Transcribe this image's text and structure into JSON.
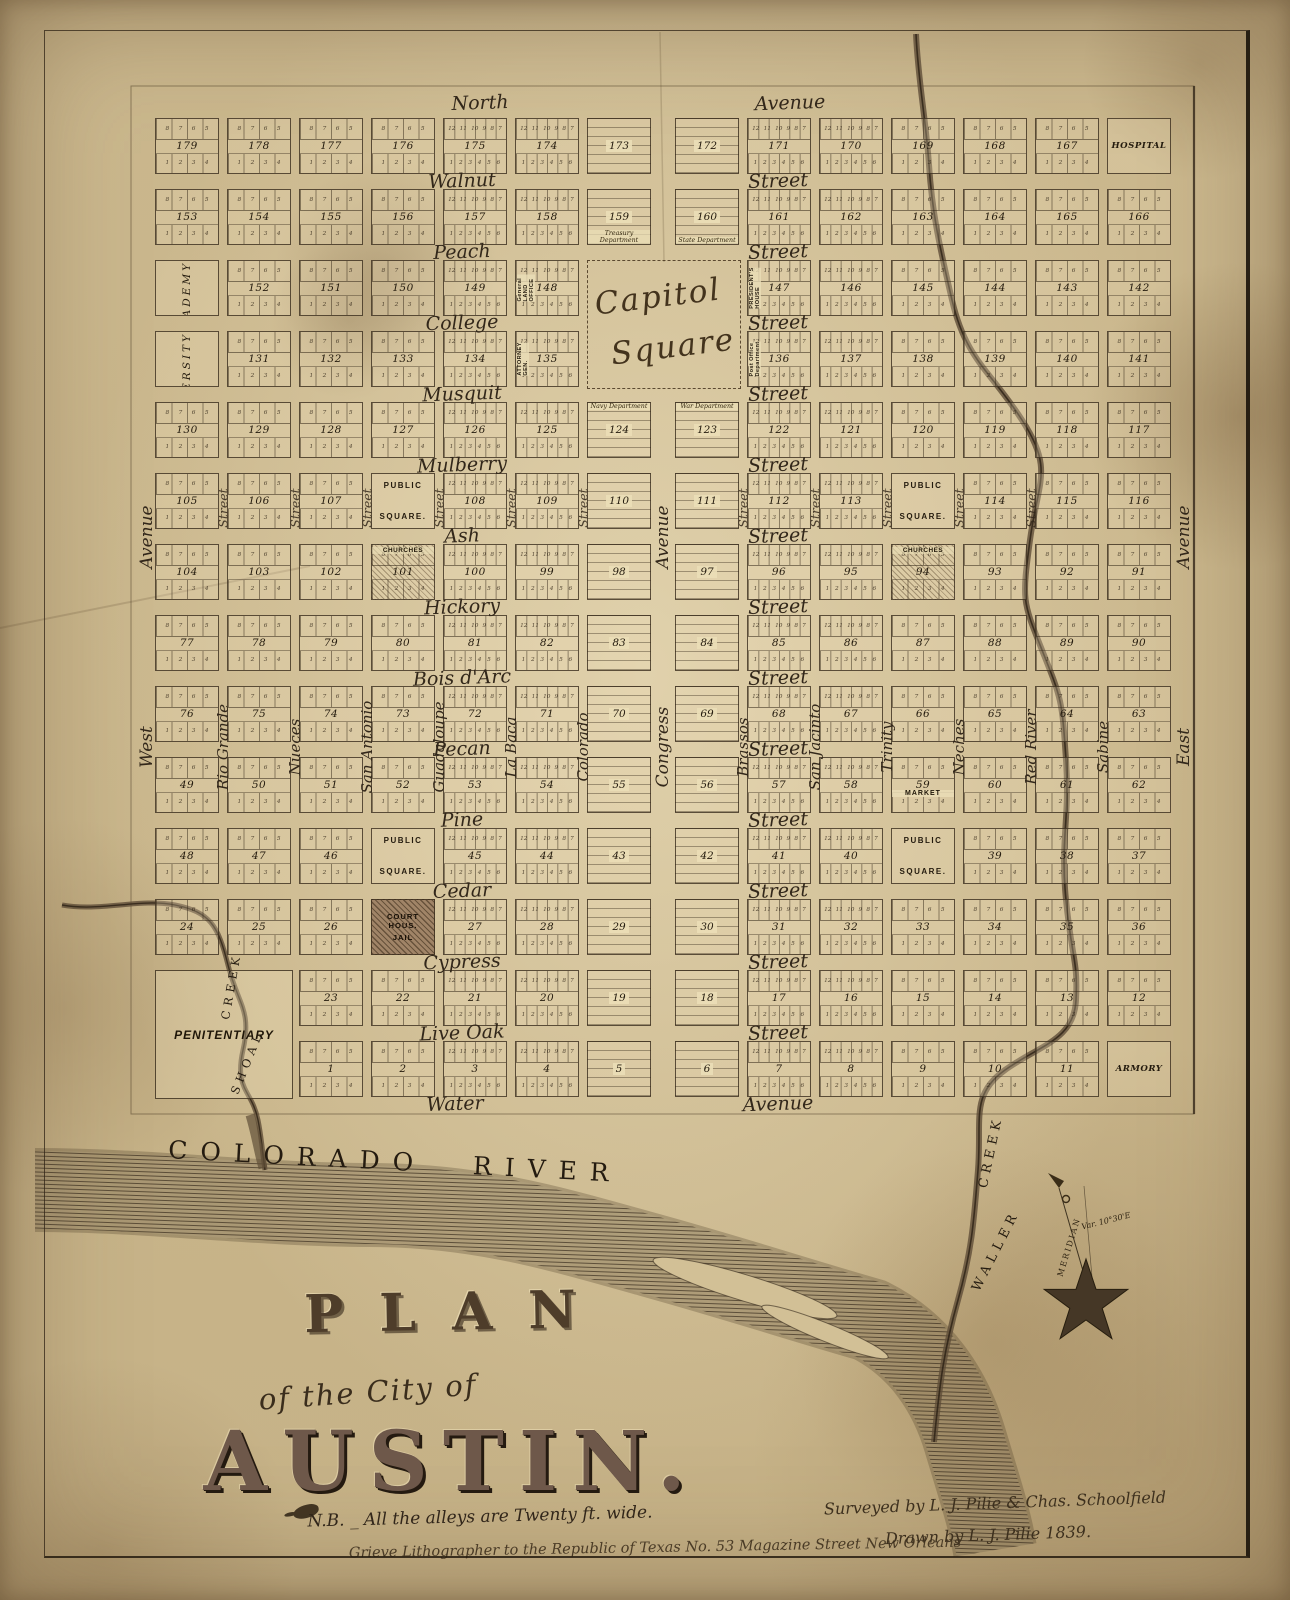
{
  "title": {
    "plan": "PLAN",
    "of_line": "of the City of",
    "city": "AUSTIN.",
    "nb_note": "N.B. _ All the alleys are Twenty ft. wide.",
    "lithographer": "Grieve Lithographer to the Republic of Texas No. 53 Magazine Street New Orleans",
    "surveyed": "Surveyed by L. J. Pilie & Chas. Schoolfield",
    "drawn": "Drawn by L. J. Pilie 1839."
  },
  "compass": {
    "meridian": "MERIDIAN",
    "variation": "Var. 10°30'E"
  },
  "waterways": {
    "river": "COLORADO RIVER",
    "creek_right_word1": "WALLER",
    "creek_right_word2": "CREEK",
    "creek_left_word1": "SHOAL",
    "creek_left_word2": "CREEK"
  },
  "streets": {
    "horizontal": [
      {
        "name": "North",
        "type": "Avenue"
      },
      {
        "name": "Walnut",
        "type": "Street"
      },
      {
        "name": "Peach",
        "type": "Street"
      },
      {
        "name": "College",
        "type": "Street"
      },
      {
        "name": "Musquit",
        "type": "Street"
      },
      {
        "name": "Mulberry",
        "type": "Street"
      },
      {
        "name": "Ash",
        "type": "Street"
      },
      {
        "name": "Hickory",
        "type": "Street"
      },
      {
        "name": "Bois d'Arc",
        "type": "Street"
      },
      {
        "name": "Pecan",
        "type": "Street"
      },
      {
        "name": "Pine",
        "type": "Street"
      },
      {
        "name": "Cedar",
        "type": "Street"
      },
      {
        "name": "Cypress",
        "type": "Street"
      },
      {
        "name": "Live Oak",
        "type": "Street"
      },
      {
        "name": "Water",
        "type": "Avenue"
      }
    ],
    "vertical": [
      {
        "name": "West",
        "type": "Avenue"
      },
      {
        "name": "Rio Grande"
      },
      {
        "name": "Nueces"
      },
      {
        "name": "San Antonio"
      },
      {
        "name": "Guadaloupe"
      },
      {
        "name": "La Baca"
      },
      {
        "name": "Colorado"
      },
      {
        "name": "Congress",
        "type": "Avenue"
      },
      {
        "name": "Brassos"
      },
      {
        "name": "San Jacinto"
      },
      {
        "name": "Trinity"
      },
      {
        "name": "Neches"
      },
      {
        "name": "Red River"
      },
      {
        "name": "Sabine"
      },
      {
        "name": "East",
        "type": "Avenue"
      }
    ],
    "cross_label": "Street"
  },
  "lot_patterns": {
    "eight": {
      "top": "8 7 6 5",
      "bottom": "1 2 3 4"
    },
    "twelve": {
      "top": "12 11 10 9 8 7",
      "bottom": "1 2 3 4 5 6"
    }
  },
  "grid": {
    "public_square_lines": [
      "PUBLIC",
      "SQUARE."
    ],
    "courthouse_lines": [
      "COURT HOUS.",
      "JAIL"
    ],
    "churches_label": "CHURCHES",
    "capitol_lines": [
      "Capitol",
      "Square"
    ],
    "penitentiary_label": "PENITENTIARY",
    "rows": [
      [
        {
          "n": "179"
        },
        {
          "n": "178"
        },
        {
          "n": "177"
        },
        {
          "n": "176"
        },
        {
          "n": "175"
        },
        {
          "n": "174"
        },
        {
          "n": "173"
        },
        {
          "n": "172"
        },
        {
          "n": "171"
        },
        {
          "n": "170"
        },
        {
          "n": "169"
        },
        {
          "n": "168"
        },
        {
          "n": "167"
        },
        {
          "hname": "HOSPITAL"
        }
      ],
      [
        {
          "n": "153"
        },
        {
          "n": "154"
        },
        {
          "n": "155"
        },
        {
          "n": "156"
        },
        {
          "n": "157"
        },
        {
          "n": "158"
        },
        {
          "n": "159",
          "cap": "Treasury Department"
        },
        {
          "n": "160",
          "cap": "State Department"
        },
        {
          "n": "161"
        },
        {
          "n": "162"
        },
        {
          "n": "163"
        },
        {
          "n": "164"
        },
        {
          "n": "165"
        },
        {
          "n": "166"
        }
      ],
      [
        {
          "vname": "ACADEMY"
        },
        {
          "n": "152"
        },
        {
          "n": "151"
        },
        {
          "n": "150"
        },
        {
          "n": "149"
        },
        {
          "n": "148",
          "vcap": "General LAND OFFICE"
        },
        null,
        null,
        {
          "n": "147",
          "vcap": "PRESIDENT'S HOUSE"
        },
        {
          "n": "146"
        },
        {
          "n": "145"
        },
        {
          "n": "144"
        },
        {
          "n": "143"
        },
        {
          "n": "142"
        }
      ],
      [
        {
          "vname": "UNIVERSITY"
        },
        {
          "n": "131"
        },
        {
          "n": "132"
        },
        {
          "n": "133"
        },
        {
          "n": "134"
        },
        {
          "n": "135",
          "vcap": "ATTORNEY GEN."
        },
        null,
        null,
        {
          "n": "136",
          "vcap": "Post Office Department"
        },
        {
          "n": "137"
        },
        {
          "n": "138"
        },
        {
          "n": "139"
        },
        {
          "n": "140"
        },
        {
          "n": "141"
        }
      ],
      [
        {
          "n": "130"
        },
        {
          "n": "129"
        },
        {
          "n": "128"
        },
        {
          "n": "127"
        },
        {
          "n": "126"
        },
        {
          "n": "125"
        },
        {
          "n": "124",
          "capTop": "Navy Department"
        },
        {
          "n": "123",
          "capTop": "War Department"
        },
        {
          "n": "122"
        },
        {
          "n": "121"
        },
        {
          "n": "120"
        },
        {
          "n": "119"
        },
        {
          "n": "118"
        },
        {
          "n": "117"
        }
      ],
      [
        {
          "n": "105"
        },
        {
          "n": "106"
        },
        {
          "n": "107"
        },
        {
          "ps": 1
        },
        {
          "n": "108"
        },
        {
          "n": "109"
        },
        {
          "n": "110"
        },
        {
          "n": "111"
        },
        {
          "n": "112"
        },
        {
          "n": "113"
        },
        {
          "ps": 1
        },
        {
          "n": "114"
        },
        {
          "n": "115"
        },
        {
          "n": "116"
        }
      ],
      [
        {
          "n": "104"
        },
        {
          "n": "103"
        },
        {
          "n": "102"
        },
        {
          "n": "101",
          "ch": 1
        },
        {
          "n": "100"
        },
        {
          "n": "99"
        },
        {
          "n": "98"
        },
        {
          "n": "97"
        },
        {
          "n": "96"
        },
        {
          "n": "95"
        },
        {
          "n": "94",
          "ch": 1
        },
        {
          "n": "93"
        },
        {
          "n": "92"
        },
        {
          "n": "91"
        }
      ],
      [
        {
          "n": "77"
        },
        {
          "n": "78"
        },
        {
          "n": "79"
        },
        {
          "n": "80"
        },
        {
          "n": "81"
        },
        {
          "n": "82"
        },
        {
          "n": "83"
        },
        {
          "n": "84"
        },
        {
          "n": "85"
        },
        {
          "n": "86"
        },
        {
          "n": "87"
        },
        {
          "n": "88"
        },
        {
          "n": "89"
        },
        {
          "n": "90"
        }
      ],
      [
        {
          "n": "76"
        },
        {
          "n": "75"
        },
        {
          "n": "74"
        },
        {
          "n": "73"
        },
        {
          "n": "72"
        },
        {
          "n": "71"
        },
        {
          "n": "70"
        },
        {
          "n": "69"
        },
        {
          "n": "68"
        },
        {
          "n": "67"
        },
        {
          "n": "66"
        },
        {
          "n": "65"
        },
        {
          "n": "64"
        },
        {
          "n": "63"
        }
      ],
      [
        {
          "n": "49"
        },
        {
          "n": "50"
        },
        {
          "n": "51"
        },
        {
          "n": "52"
        },
        {
          "n": "53"
        },
        {
          "n": "54"
        },
        {
          "n": "55"
        },
        {
          "n": "56"
        },
        {
          "n": "57"
        },
        {
          "n": "58"
        },
        {
          "n": "59",
          "mk": "MARKET"
        },
        {
          "n": "60"
        },
        {
          "n": "61"
        },
        {
          "n": "62"
        }
      ],
      [
        {
          "n": "48"
        },
        {
          "n": "47"
        },
        {
          "n": "46"
        },
        {
          "ps": 1
        },
        {
          "n": "45"
        },
        {
          "n": "44"
        },
        {
          "n": "43"
        },
        {
          "n": "42"
        },
        {
          "n": "41"
        },
        {
          "n": "40"
        },
        {
          "ps": 1
        },
        {
          "n": "39"
        },
        {
          "n": "38"
        },
        {
          "n": "37"
        }
      ],
      [
        {
          "n": "24"
        },
        {
          "n": "25"
        },
        {
          "n": "26"
        },
        {
          "cj": 1
        },
        {
          "n": "27"
        },
        {
          "n": "28"
        },
        {
          "n": "29"
        },
        {
          "n": "30"
        },
        {
          "n": "31"
        },
        {
          "n": "32"
        },
        {
          "n": "33"
        },
        {
          "n": "34"
        },
        {
          "n": "35"
        },
        {
          "n": "36"
        }
      ],
      [
        null,
        null,
        {
          "n": "23"
        },
        {
          "n": "22"
        },
        {
          "n": "21"
        },
        {
          "n": "20"
        },
        {
          "n": "19"
        },
        {
          "n": "18"
        },
        {
          "n": "17"
        },
        {
          "n": "16"
        },
        {
          "n": "15"
        },
        {
          "n": "14"
        },
        {
          "n": "13"
        },
        {
          "n": "12"
        }
      ],
      [
        null,
        null,
        {
          "n": "1"
        },
        {
          "n": "2"
        },
        {
          "n": "3"
        },
        {
          "n": "4"
        },
        {
          "n": "5"
        },
        {
          "n": "6"
        },
        {
          "n": "7"
        },
        {
          "n": "8"
        },
        {
          "n": "9"
        },
        {
          "n": "10"
        },
        {
          "n": "11"
        },
        {
          "hname": "ARMORY"
        }
      ]
    ]
  }
}
